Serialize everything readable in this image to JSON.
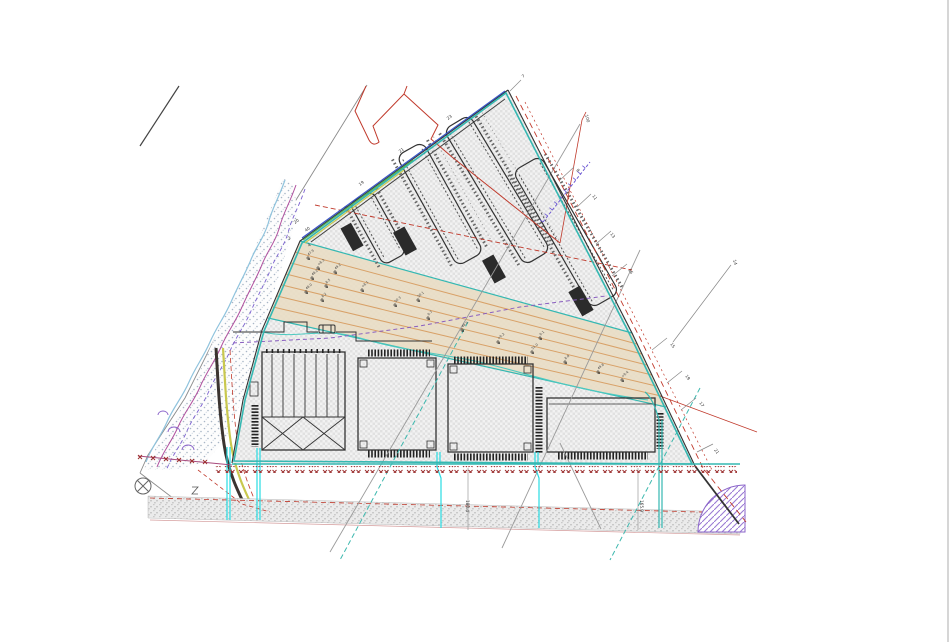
{
  "canvas": {
    "width": 950,
    "height": 642
  },
  "drawing": {
    "type": "site-plan"
  },
  "colors": {
    "site_boundary_teal": "#35b8b2",
    "boundary_black": "#333333",
    "utility_cyan": "#29dbe3",
    "fence_red": "#9c2f2f",
    "red_line": "#c0392b",
    "magenta_stream": "#b0509e",
    "purple_line": "#8a5fc0",
    "purple_ticked": "#6f5bd4",
    "blue_strip": "#3a57c9",
    "green_strip": "#52b05c",
    "yellow_strip": "#c9c84f",
    "tan_corridor": "#e9dcc2",
    "orange_corridor_line": "#d79b5e",
    "gray_line": "#8a8a8a",
    "dark_road_edge": "#3b3430",
    "purple_hatch": "#9b7bd4",
    "floodplain_dot": "#a8b6c6",
    "road_hatch": "#c9c9c9",
    "site_hatch": "#e1e1e1"
  },
  "labels": {
    "edge_points": [
      {
        "text": "7",
        "x": 523,
        "y": 78,
        "r": -36
      },
      {
        "text": "23",
        "x": 448,
        "y": 120,
        "r": -36
      },
      {
        "text": "21",
        "x": 400,
        "y": 153,
        "r": -36
      },
      {
        "text": "19",
        "x": 360,
        "y": 186,
        "r": -36
      },
      {
        "text": "9",
        "x": 576,
        "y": 170,
        "r": 55
      },
      {
        "text": "11",
        "x": 592,
        "y": 196,
        "r": 55
      },
      {
        "text": "13",
        "x": 610,
        "y": 234,
        "r": 55
      },
      {
        "text": "16",
        "x": 628,
        "y": 270,
        "r": 55
      },
      {
        "text": "15",
        "x": 670,
        "y": 344,
        "r": 55
      },
      {
        "text": "19",
        "x": 685,
        "y": 376,
        "r": 55
      },
      {
        "text": "17",
        "x": 699,
        "y": 403,
        "r": 55
      },
      {
        "text": "21",
        "x": 714,
        "y": 450,
        "r": 55
      },
      {
        "text": "14",
        "x": 733,
        "y": 260,
        "r": 75
      },
      {
        "text": "100",
        "x": 585,
        "y": 115,
        "r": 75
      },
      {
        "text": "20",
        "x": 295,
        "y": 224,
        "r": -36
      },
      {
        "text": "40",
        "x": 306,
        "y": 232,
        "r": -36
      },
      {
        "text": "2",
        "x": 289,
        "y": 240,
        "r": -36
      },
      {
        "text": "4",
        "x": 309,
        "y": 247,
        "r": -36
      },
      {
        "text": "180.4",
        "x": 466,
        "y": 500,
        "r": 90
      },
      {
        "text": "165.9",
        "x": 640,
        "y": 500,
        "r": 90
      }
    ],
    "survey_points": [
      {
        "text": "49.2",
        "x": 335,
        "y": 272
      },
      {
        "text": "+8.1",
        "x": 362,
        "y": 290
      },
      {
        "text": "50.3",
        "x": 395,
        "y": 305
      },
      {
        "text": "9.7",
        "x": 428,
        "y": 318
      },
      {
        "text": "48.6",
        "x": 462,
        "y": 330
      },
      {
        "text": "+9.2",
        "x": 498,
        "y": 342
      },
      {
        "text": "51.0",
        "x": 532,
        "y": 352
      },
      {
        "text": "8.8",
        "x": 565,
        "y": 362
      },
      {
        "text": "49.8",
        "x": 598,
        "y": 372
      },
      {
        "text": "+9.4",
        "x": 622,
        "y": 380
      },
      {
        "text": "50.1",
        "x": 418,
        "y": 300
      },
      {
        "text": "9.1",
        "x": 540,
        "y": 338
      },
      {
        "text": "47.9",
        "x": 308,
        "y": 258
      },
      {
        "text": "+8.3",
        "x": 318,
        "y": 268
      },
      {
        "text": "48.2",
        "x": 312,
        "y": 278
      },
      {
        "text": "8.5",
        "x": 326,
        "y": 286
      },
      {
        "text": "48.0",
        "x": 306,
        "y": 292
      },
      {
        "text": "8.2",
        "x": 322,
        "y": 300
      }
    ]
  }
}
